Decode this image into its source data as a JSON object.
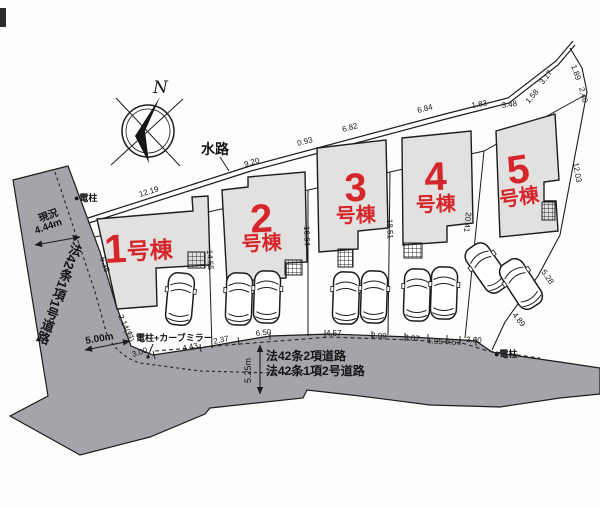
{
  "meta": {
    "title": "分譲住宅 区画配置図",
    "type": "site-plan-drawing"
  },
  "colors": {
    "road": "#a7a3ab",
    "building_fill": "#e3e1e0",
    "line": "#1c1c1c",
    "accent_red": "#d5262b",
    "background": "#fdfdfc"
  },
  "compass": {
    "label": "N"
  },
  "waterway": {
    "label": "水路"
  },
  "buildings": [
    {
      "n": "building-1-label",
      "num": "1",
      "suffix": "号棟",
      "inline": true,
      "cx": 104,
      "cy": 263,
      "rot": -3
    },
    {
      "n": "building-2-label",
      "num": "2",
      "suffix": "号棟",
      "inline": false,
      "cx": 262,
      "ny": 232,
      "sy": 250,
      "rot": -3
    },
    {
      "n": "building-3-label",
      "num": "3",
      "suffix": "号棟",
      "inline": false,
      "cx": 356,
      "ny": 201,
      "sy": 222,
      "rot": -2
    },
    {
      "n": "building-4-label",
      "num": "4",
      "suffix": "号棟",
      "inline": false,
      "cx": 436,
      "ny": 190,
      "sy": 211,
      "rot": -2
    },
    {
      "n": "building-5-label",
      "num": "5",
      "suffix": "号棟",
      "inline": false,
      "cx": 520,
      "ny": 183,
      "sy": 204,
      "rot": -8
    }
  ],
  "labels": [
    {
      "n": "waterway-label",
      "t": "水路",
      "x": 201,
      "y": 154,
      "s": 14,
      "w": 700
    },
    {
      "n": "dim-12-19",
      "t": "12.19",
      "x": 140,
      "y": 197,
      "s": 8,
      "r": -17
    },
    {
      "n": "dim-9-20",
      "t": "9.20",
      "x": 245,
      "y": 167,
      "s": 8,
      "r": -16
    },
    {
      "n": "dim-0-93",
      "t": "0.93",
      "x": 298,
      "y": 146,
      "s": 8,
      "r": -15
    },
    {
      "n": "dim-6-82",
      "t": "6.82",
      "x": 343,
      "y": 132,
      "s": 8,
      "r": -15
    },
    {
      "n": "dim-6-84",
      "t": "6.84",
      "x": 418,
      "y": 113,
      "s": 8,
      "r": -14
    },
    {
      "n": "dim-1-83",
      "t": "1.83",
      "x": 472,
      "y": 108,
      "s": 8,
      "r": -10
    },
    {
      "n": "dim-3-48",
      "t": "3.48",
      "x": 502,
      "y": 108,
      "s": 8,
      "r": -8
    },
    {
      "n": "dim-1-58",
      "t": "1.58",
      "x": 529,
      "y": 104,
      "s": 8,
      "r": -50
    },
    {
      "n": "dim-3-17",
      "t": "3.17",
      "x": 543,
      "y": 85,
      "s": 8,
      "r": -52
    },
    {
      "n": "dim-1-89",
      "t": "1.89",
      "x": 571,
      "y": 66,
      "s": 8,
      "r": 70
    },
    {
      "n": "dim-2-40",
      "t": "2.40",
      "x": 579,
      "y": 88,
      "s": 8,
      "r": 76
    },
    {
      "n": "dim-12-03",
      "t": "12.03",
      "x": 573,
      "y": 163,
      "s": 8,
      "r": 80
    },
    {
      "n": "dim-5-28",
      "t": "5.28",
      "x": 541,
      "y": 272,
      "s": 8,
      "r": 55
    },
    {
      "n": "dim-4-89",
      "t": "4.89",
      "x": 512,
      "y": 315,
      "s": 8,
      "r": 52
    },
    {
      "n": "dim-14-55",
      "t": "14.55",
      "x": 207,
      "y": 250,
      "s": 8,
      "r": 87
    },
    {
      "n": "dim-16-64",
      "t": "16.64",
      "x": 304,
      "y": 226,
      "s": 8,
      "r": 88
    },
    {
      "n": "dim-18-51",
      "t": "18.51",
      "x": 387,
      "y": 219,
      "s": 8,
      "r": 88
    },
    {
      "n": "dim-20-41",
      "t": "20.41",
      "x": 466,
      "y": 212,
      "s": 8,
      "r": 96
    },
    {
      "n": "dim-6-35",
      "t": "6.35",
      "x": 100,
      "y": 258,
      "s": 8,
      "r": 72
    },
    {
      "n": "dim-2-14-diag",
      "t": "2.14(斜)",
      "x": 118,
      "y": 316,
      "s": 8,
      "r": 66
    },
    {
      "n": "dim-3-00",
      "t": "3.00",
      "x": 133,
      "y": 357,
      "s": 8,
      "r": -18
    },
    {
      "n": "dim-4-43",
      "t": "4.43",
      "x": 183,
      "y": 351,
      "s": 8,
      "r": -12
    },
    {
      "n": "dim-2-37",
      "t": "2.37",
      "x": 214,
      "y": 344,
      "s": 8,
      "r": -12
    },
    {
      "n": "dim-6-50",
      "t": "6.50",
      "x": 256,
      "y": 336,
      "s": 8,
      "r": -6
    },
    {
      "n": "dim-4-57",
      "t": "4.57",
      "x": 326,
      "y": 336,
      "s": 8,
      "r": 0
    },
    {
      "n": "dim-2-99",
      "t": "2.99",
      "x": 371,
      "y": 338,
      "s": 8,
      "r": 2
    },
    {
      "n": "dim-3-07",
      "t": "3.07",
      "x": 404,
      "y": 340,
      "s": 8,
      "r": 5
    },
    {
      "n": "dim-1-95",
      "t": "1.95",
      "x": 427,
      "y": 343,
      "s": 8,
      "r": 5
    },
    {
      "n": "dim-0-57",
      "t": "0.57",
      "x": 445,
      "y": 344,
      "s": 8,
      "r": 5
    },
    {
      "n": "dim-3-60",
      "t": "3.60",
      "x": 466,
      "y": 342,
      "s": 8,
      "r": 3
    },
    {
      "n": "status-label",
      "t": "現況",
      "x": 40,
      "y": 222,
      "s": 10,
      "w": 700,
      "r": -20
    },
    {
      "n": "dim-4-44m",
      "t": "4.44m",
      "x": 36,
      "y": 234,
      "s": 10,
      "w": 700,
      "r": -20
    },
    {
      "n": "dim-5-00m",
      "t": "5.00m",
      "x": 86,
      "y": 344,
      "s": 10,
      "w": 700,
      "r": -10
    },
    {
      "n": "dim-5-25m",
      "t": "5.25m",
      "x": 251,
      "y": 383,
      "s": 9,
      "w": 400,
      "r": -90
    },
    {
      "n": "road-law-42-2",
      "t": "法42条2項道路",
      "x": 266,
      "y": 360,
      "s": 12,
      "w": 700
    },
    {
      "n": "road-law-42-1-2",
      "t": "法42条1項2号道路",
      "x": 266,
      "y": 375,
      "s": 12,
      "w": 700
    },
    {
      "n": "road-law-42-1-1",
      "t": "法42条1項1号道路",
      "x": 77,
      "y": 243,
      "s": 13,
      "w": 700,
      "r": 20,
      "v": 1
    },
    {
      "n": "pole-mirror-label",
      "t": "電柱+カーブミラー",
      "x": 136,
      "y": 341,
      "s": 9,
      "w": 700
    },
    {
      "n": "pole-label-top",
      "t": "●電柱",
      "x": 74,
      "y": 201,
      "s": 9,
      "w": 700
    },
    {
      "n": "pole-label-right",
      "t": "●電柱",
      "x": 494,
      "y": 357,
      "s": 9,
      "w": 700
    },
    {
      "n": "compass-n-label",
      "t": "N",
      "x": 153,
      "y": 93,
      "s": 17,
      "w": 400,
      "i": 1,
      "serif": 1
    }
  ]
}
